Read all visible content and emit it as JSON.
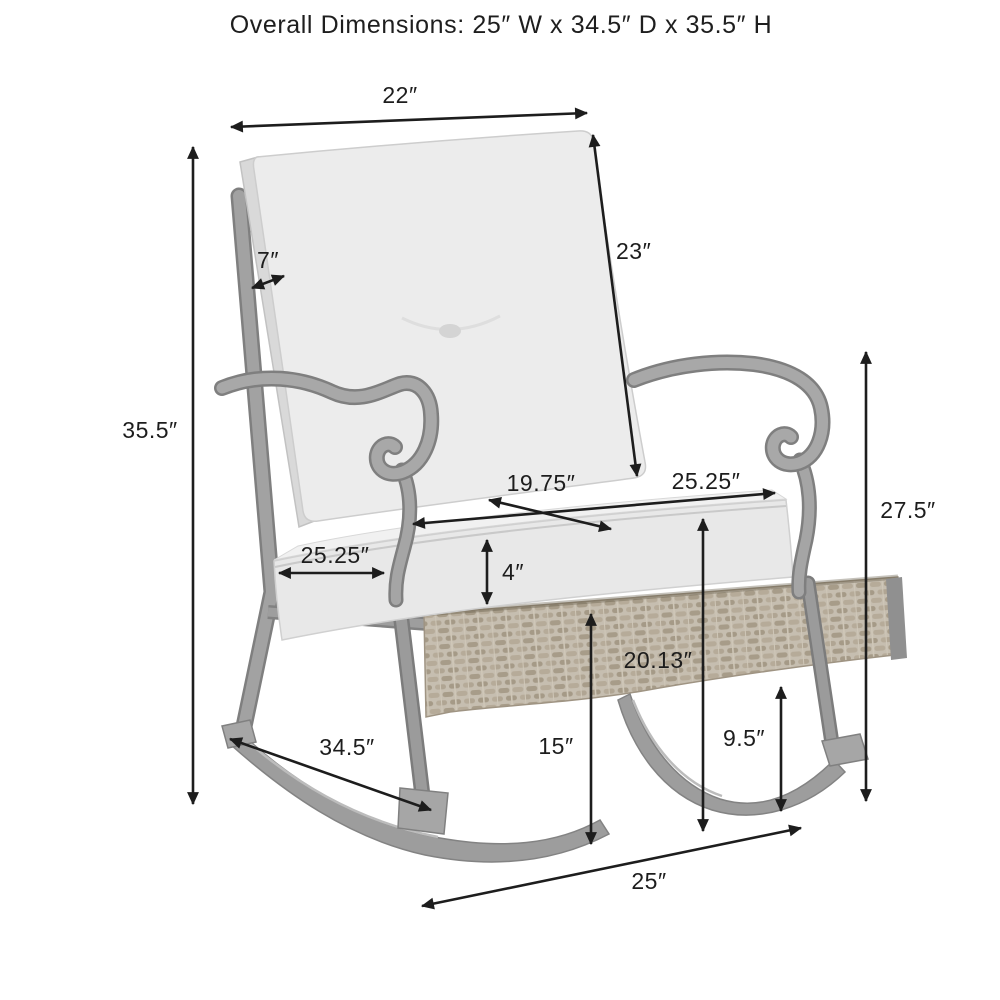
{
  "title": "Overall Dimensions: 25″ W x 34.5″ D x 35.5″ H",
  "labels": {
    "back_width": "22″",
    "back_cushion_height": "23″",
    "back_thickness": "7″",
    "overall_height": "35.5″",
    "seat_cushion_depth": "25.25″",
    "seat_cushion_width": "25.25″",
    "seat_interior_width": "19.75″",
    "seat_cushion_thickness": "4″",
    "arm_height": "27.5″",
    "seat_height": "20.13″",
    "deck_height": "15″",
    "rocker_clearance": "9.5″",
    "rocker_depth": "34.5″",
    "overall_width": "25″"
  },
  "colors": {
    "background": "#ffffff",
    "dimension_lines": "#1d1d1d",
    "label_text": "#1d1d1d",
    "cushion": "#ececec",
    "cushion_shade": "#d9d9d9",
    "frame": "#a2a2a2",
    "frame_dark": "#7f7f7f",
    "wicker": "#c6beb0",
    "wicker_weave": "#a59a87"
  }
}
